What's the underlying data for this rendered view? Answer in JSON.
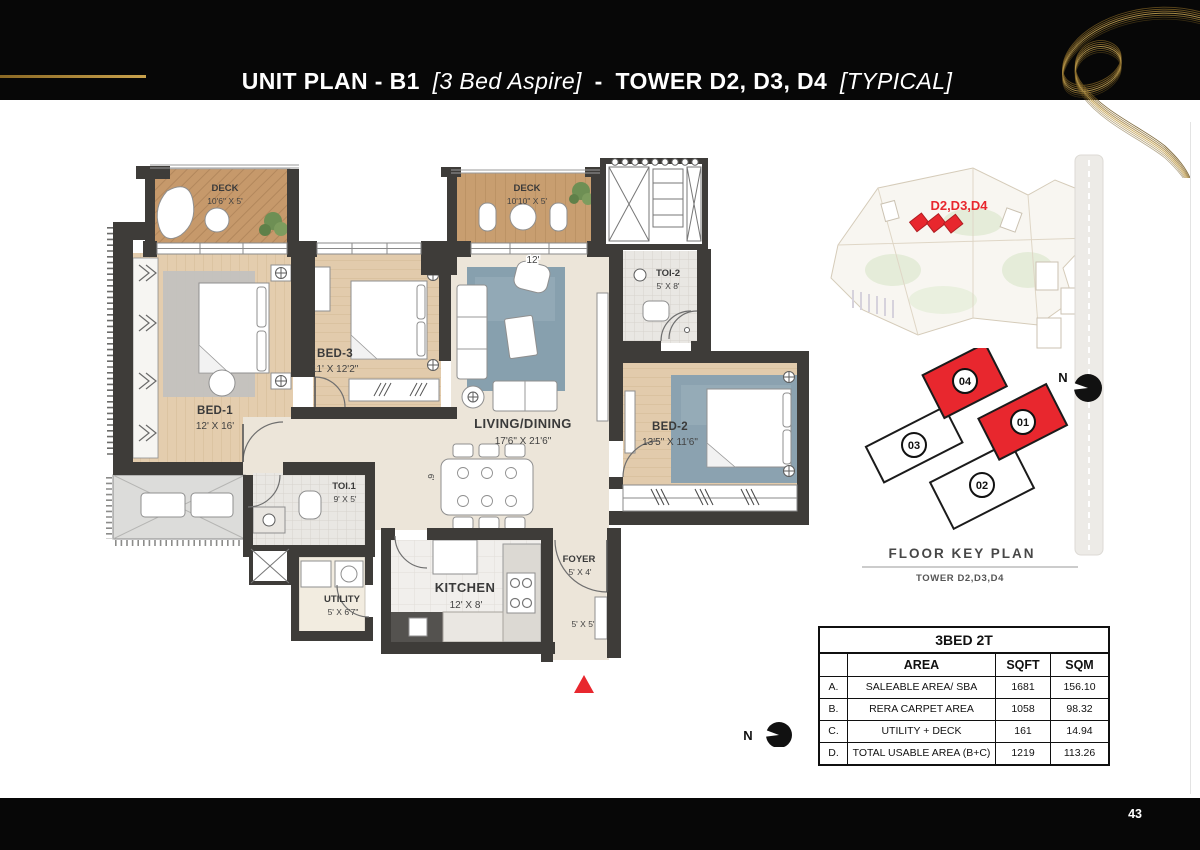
{
  "header": {
    "title_main": "UNIT PLAN - B1",
    "title_aspire": "[3 Bed Aspire]",
    "title_sep": "-",
    "title_tower": "TOWER D2, D3, D4",
    "title_typical": "[TYPICAL]"
  },
  "footer": {
    "page": "43"
  },
  "plan": {
    "north": "N",
    "rooms": [
      {
        "name": "DECK",
        "dims": "10'6\" X 5'"
      },
      {
        "name": "DECK",
        "dims": "10'10\" X 5'"
      },
      {
        "name": "BED-1",
        "dims": "12' X 16'"
      },
      {
        "name": "BED-3",
        "dims": "11' X 12'2\""
      },
      {
        "name": "LIVING/DINING",
        "dims": "17'6\" X 21'6\""
      },
      {
        "name": "TOI-2",
        "dims": "5' X 8'"
      },
      {
        "name": "BED-2",
        "dims": "13'5\" X 11'6\""
      },
      {
        "name": "TOI.1",
        "dims": "9' X 5'"
      },
      {
        "name": "UTILITY",
        "dims": "5' X 6'7\""
      },
      {
        "name": "KITCHEN",
        "dims": "12' X 8'"
      },
      {
        "name": "FOYER",
        "dims": "5' X 4'"
      }
    ],
    "annotations": {
      "width_top": "12'",
      "hall": "6'",
      "entry": "5' X 5'"
    }
  },
  "site_map": {
    "highlight_label": "D2,D3,D4"
  },
  "key_plan": {
    "title": "FLOOR KEY PLAN",
    "tower": "TOWER D2,D3,D4",
    "north": "N",
    "units": [
      {
        "num": "04",
        "highlighted": true
      },
      {
        "num": "01",
        "highlighted": true
      },
      {
        "num": "03",
        "highlighted": false
      },
      {
        "num": "02",
        "highlighted": false
      }
    ]
  },
  "area_table": {
    "title": "3BED 2T",
    "headers": [
      "AREA",
      "SQFT",
      "SQM"
    ],
    "rows": [
      {
        "key": "A.",
        "area": "SALEABLE AREA/ SBA",
        "sqft": "1681",
        "sqm": "156.10"
      },
      {
        "key": "B.",
        "area": "RERA CARPET AREA",
        "sqft": "1058",
        "sqm": "98.32"
      },
      {
        "key": "C.",
        "area": "UTILITY + DECK",
        "sqft": "161",
        "sqm": "14.94"
      },
      {
        "key": "D.",
        "area": "TOTAL USABLE AREA (B+C)",
        "sqft": "1219",
        "sqm": "113.26"
      }
    ]
  },
  "colors": {
    "accent_red": "#e8272e",
    "gold": "#b08d3e",
    "wall": "#3e3c39"
  }
}
